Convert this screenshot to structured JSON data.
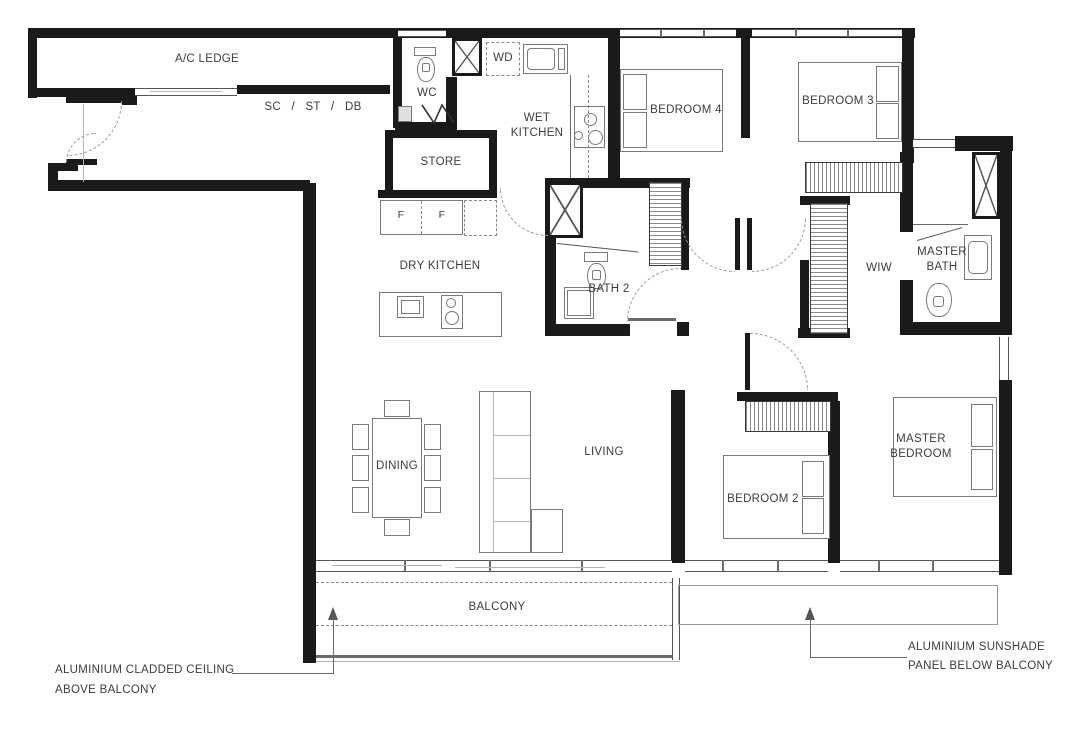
{
  "rooms": {
    "ac_ledge": "A/C LEDGE",
    "closet_band": "SC / ST / DB",
    "wc": "WC",
    "wd": "WD",
    "store": "STORE",
    "wet_kitchen": "WET KITCHEN",
    "dry_kitchen": "DRY KITCHEN",
    "fridge_1": "F",
    "fridge_2": "F",
    "bath2": "BATH 2",
    "bedroom4": "BEDROOM 4",
    "bedroom3": "BEDROOM 3",
    "wiw": "WIW",
    "master_bath": "MASTER BATH",
    "living": "LIVING",
    "dining": "DINING",
    "bedroom2": "BEDROOM 2",
    "master_bedroom": "MASTER BEDROOM",
    "balcony": "BALCONY"
  },
  "annotations": {
    "ceiling_line1": "ALUMINIUM CLADDED CEILING",
    "ceiling_line2": "ABOVE BALCONY",
    "sunshade_line1": "ALUMINIUM SUNSHADE",
    "sunshade_line2": "PANEL BELOW BALCONY"
  },
  "colors": {
    "wall": "#1a1a1a",
    "furniture_line": "#7a7a7a",
    "dashed_line": "#999999",
    "text": "#3c3c3c",
    "background": "#ffffff"
  }
}
